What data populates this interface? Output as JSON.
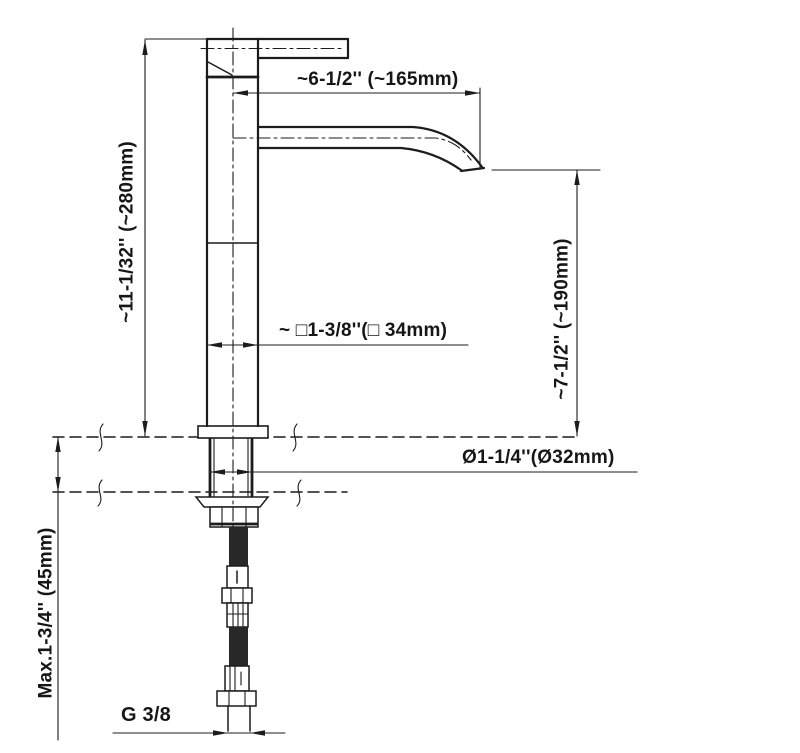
{
  "drawing": {
    "labels": {
      "spout_reach": "~6-1/2'' (~165mm)",
      "total_height": "~11-1/32'' (~280mm)",
      "spout_height": "~7-1/2'' (~190mm)",
      "body_width": "~ □1-3/8''(□ 34mm)",
      "hole_diameter": "Ø1-1/4''(Ø32mm)",
      "deck_thickness": "Max.1-3/4'' (45mm)",
      "thread_size": "G 3/8"
    },
    "colors": {
      "line": "#1c1c1c",
      "background": "#ffffff",
      "hose": "#282828"
    }
  }
}
